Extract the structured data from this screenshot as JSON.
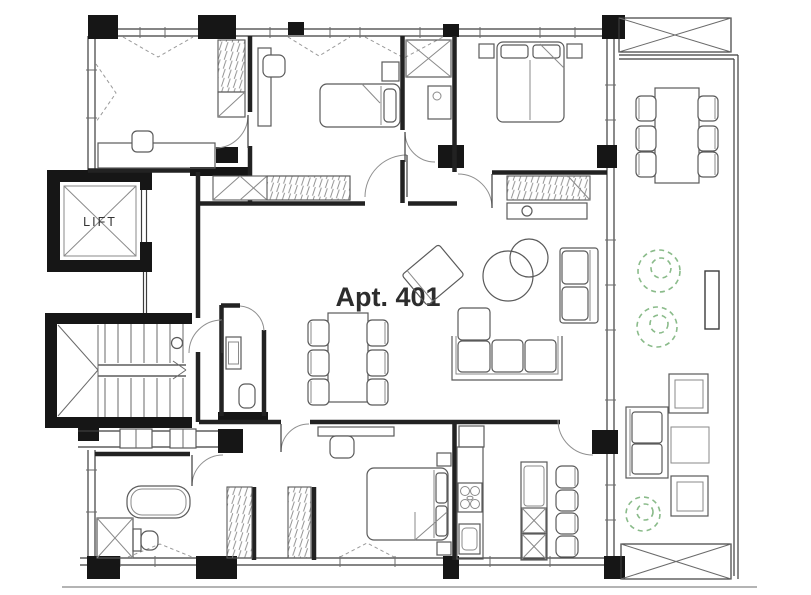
{
  "drawing": {
    "apartment_label": "Apt. 401",
    "lift_label": "LIFT"
  },
  "colors": {
    "background": "#ffffff",
    "structure_black": "#161616",
    "partition_wall": "#222222",
    "thin_line": "#3c3c3c",
    "furniture_line": "#5a5a5a",
    "plant_green": "#8abb8a",
    "label_text": "#2d2d2d"
  }
}
